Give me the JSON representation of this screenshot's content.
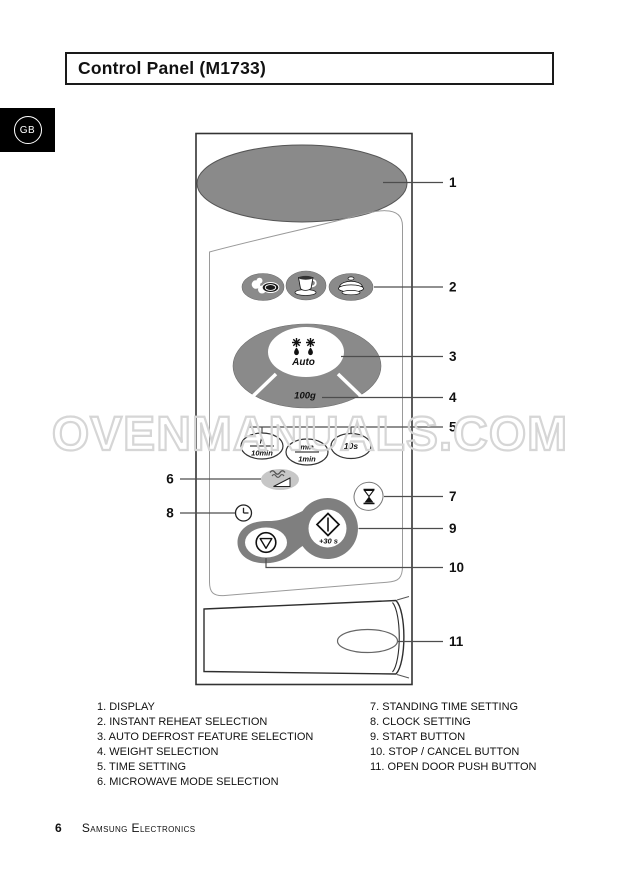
{
  "badge": {
    "label": "GB"
  },
  "header": {
    "title": "Control Panel (M1733)"
  },
  "watermark": {
    "text": "OVENMANUALS.COM"
  },
  "colors": {
    "display_gray": "#8a8a8a",
    "button_gray": "#8a8a8a",
    "peanut_gray": "#7f7f7f",
    "mode_button_gray": "#c7c7c7",
    "badge_background": "#000000"
  },
  "diagram": {
    "auto_label": "Auto",
    "weight_label": "100g",
    "start_boost_label": "+30 s",
    "time_h_top": "h",
    "time_h_bottom": "10min",
    "time_min_top": "min",
    "time_min_bottom": "1min",
    "time_sec": "10s",
    "icons": [
      "display-ellipse",
      "plate-icon",
      "coffee-cup-icon",
      "casserole-icon",
      "defrost-icon",
      "hourglass-icon",
      "clock-icon",
      "microwave-waves-icon",
      "power-wedge-icon",
      "start-diamond-icon",
      "stop-icon",
      "door-oval"
    ]
  },
  "callouts": {
    "c1": "1",
    "c2": "2",
    "c3": "3",
    "c4": "4",
    "c5": "5",
    "c6": "6",
    "c7": "7",
    "c8": "8",
    "c9": "9",
    "c10": "10",
    "c11": "11"
  },
  "legend": {
    "left": [
      "1. DISPLAY",
      "2. INSTANT REHEAT SELECTION",
      "3. AUTO DEFROST FEATURE SELECTION",
      "4. WEIGHT SELECTION",
      "5. TIME SETTING",
      "6. MICROWAVE MODE SELECTION"
    ],
    "right": [
      "7. STANDING TIME SETTING",
      "8. CLOCK SETTING",
      "9. START BUTTON",
      "10. STOP / CANCEL BUTTON",
      "11. OPEN DOOR PUSH BUTTON"
    ]
  },
  "footer": {
    "page_number": "6",
    "brand": "Samsung Electronics"
  }
}
